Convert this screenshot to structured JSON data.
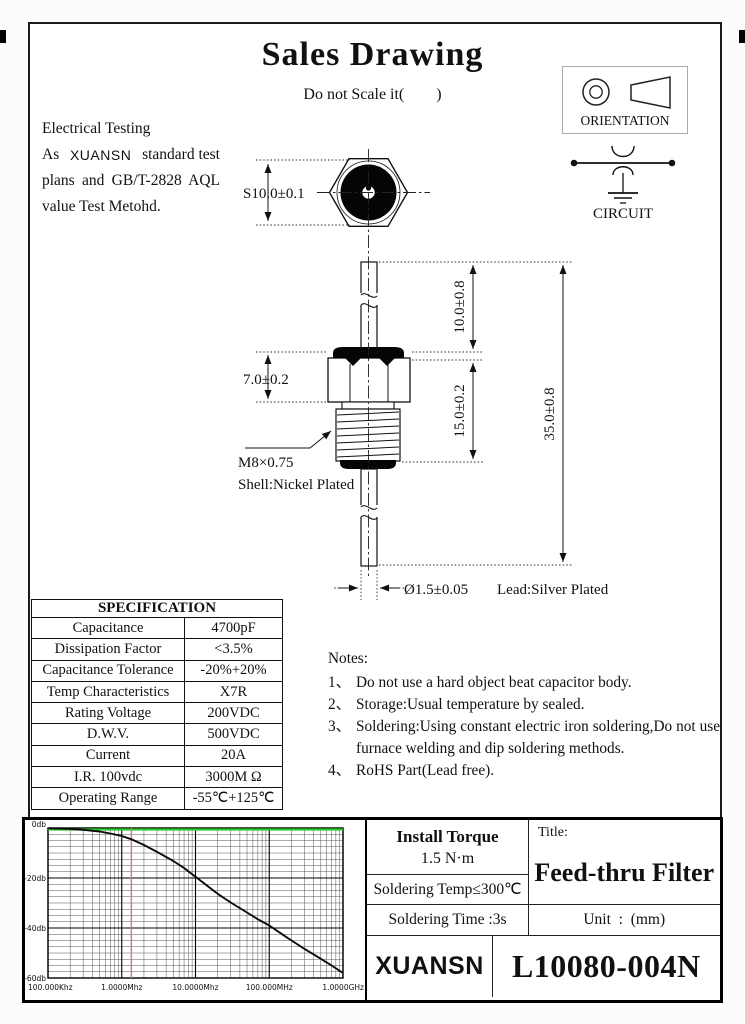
{
  "page": {
    "title": "Sales Drawing",
    "subtitle": "Do not Scale it(        )"
  },
  "header_note": {
    "line1": "Electrical Testing",
    "line2": [
      "As",
      "XUANSN",
      "standard test"
    ],
    "line3": "plans and GB/T-2828 AQL",
    "line4": "value Test Metohd."
  },
  "symbols": {
    "orientation_label": "ORIENTATION",
    "circuit_label": "CIRCUIT"
  },
  "drawing_dims": {
    "width_across_flats": "S10.0±0.1",
    "hex_height": "7.0±0.2",
    "top_lead": "10.0±0.8",
    "body_length": "15.0±0.2",
    "overall_length": "35.0±0.8",
    "thread": "M8×0.75",
    "shell_finish": "Shell:Nickel Plated",
    "lead_diameter": "Ø1.5±0.05",
    "lead_finish": "Lead:Silver Plated"
  },
  "specification": {
    "title": "SPECIFICATION",
    "rows": [
      {
        "label": "Capacitance",
        "value": "4700pF"
      },
      {
        "label": "Dissipation Factor",
        "value": "<3.5%"
      },
      {
        "label": "Capacitance Tolerance",
        "value": "-20%+20%"
      },
      {
        "label": "Temp Characteristics",
        "value": "X7R"
      },
      {
        "label": "Rating Voltage",
        "value": "200VDC"
      },
      {
        "label": "D.W.V.",
        "value": "500VDC"
      },
      {
        "label": "Current",
        "value": "20A"
      },
      {
        "label": "I.R. 100vdc",
        "value": "3000M Ω"
      },
      {
        "label": "Operating Range",
        "value": "-55℃+125℃"
      }
    ]
  },
  "notes": {
    "heading": "Notes:",
    "items": [
      {
        "num": "1、",
        "text": "Do not use a hard object beat capacitor body."
      },
      {
        "num": "2、",
        "text": "Storage:Usual temperature by sealed."
      },
      {
        "num": "3、",
        "text": "Soldering:Using constant electric iron soldering,Do not use furnace welding and dip soldering methods."
      },
      {
        "num": "4、",
        "text": "RoHS Part(Lead free)."
      }
    ]
  },
  "title_block": {
    "install_torque_label": "Install Torque",
    "install_torque_value": "1.5 N·m",
    "soldering_temp": "Soldering Temp≤300℃",
    "soldering_time": "Soldering Time :3s",
    "title_label": "Title:",
    "product_title": "Feed-thru Filter",
    "unit": "Unit  :  (mm)",
    "brand": "XUANSN",
    "part_number": "L10080-004N"
  },
  "chart_data": {
    "type": "line",
    "title": "Insertion loss vs frequency",
    "x_scale": "log",
    "x_unit": "MHz",
    "x_range_mhz": [
      0.1,
      1000
    ],
    "y_range_db": [
      -60,
      0
    ],
    "y_major_step_db": 20,
    "y_minor_step_db": 2.5,
    "grid": true,
    "x_ticks": [
      {
        "label": "100.000Khz",
        "mhz": 0.1
      },
      {
        "label": "1.0000Mhz",
        "mhz": 1
      },
      {
        "label": "10.0000Mhz",
        "mhz": 10
      },
      {
        "label": "100.000MHz",
        "mhz": 100
      },
      {
        "label": "1.0000GHz",
        "mhz": 1000
      }
    ],
    "y_ticks": [
      {
        "label": "0db",
        "db": 0
      },
      {
        "label": "-20db",
        "db": -20
      },
      {
        "label": "-40db",
        "db": -40
      },
      {
        "label": "-60db",
        "db": -60
      }
    ],
    "reference_line": {
      "db": 0,
      "color": "#2fca2f"
    },
    "marker_line": {
      "mhz": 1.35,
      "color": "#c47e8e"
    },
    "series": [
      {
        "name": "insertion-loss",
        "color": "#0a0a0a",
        "points_mhz_db": [
          [
            0.1,
            -0.1
          ],
          [
            0.15,
            -0.2
          ],
          [
            0.2,
            -0.35
          ],
          [
            0.3,
            -0.7
          ],
          [
            0.5,
            -1.4
          ],
          [
            0.7,
            -2.2
          ],
          [
            1,
            -3.2
          ],
          [
            1.35,
            -4.5
          ],
          [
            2,
            -6.8
          ],
          [
            3,
            -9.5
          ],
          [
            5,
            -13.2
          ],
          [
            7,
            -16
          ],
          [
            10,
            -19.5
          ],
          [
            15,
            -23.5
          ],
          [
            20,
            -26.3
          ],
          [
            30,
            -29.8
          ],
          [
            50,
            -33.8
          ],
          [
            70,
            -36.5
          ],
          [
            100,
            -39
          ],
          [
            150,
            -42.5
          ],
          [
            200,
            -45
          ],
          [
            300,
            -48.3
          ],
          [
            500,
            -52.3
          ],
          [
            700,
            -55
          ],
          [
            1000,
            -58
          ]
        ]
      }
    ]
  }
}
